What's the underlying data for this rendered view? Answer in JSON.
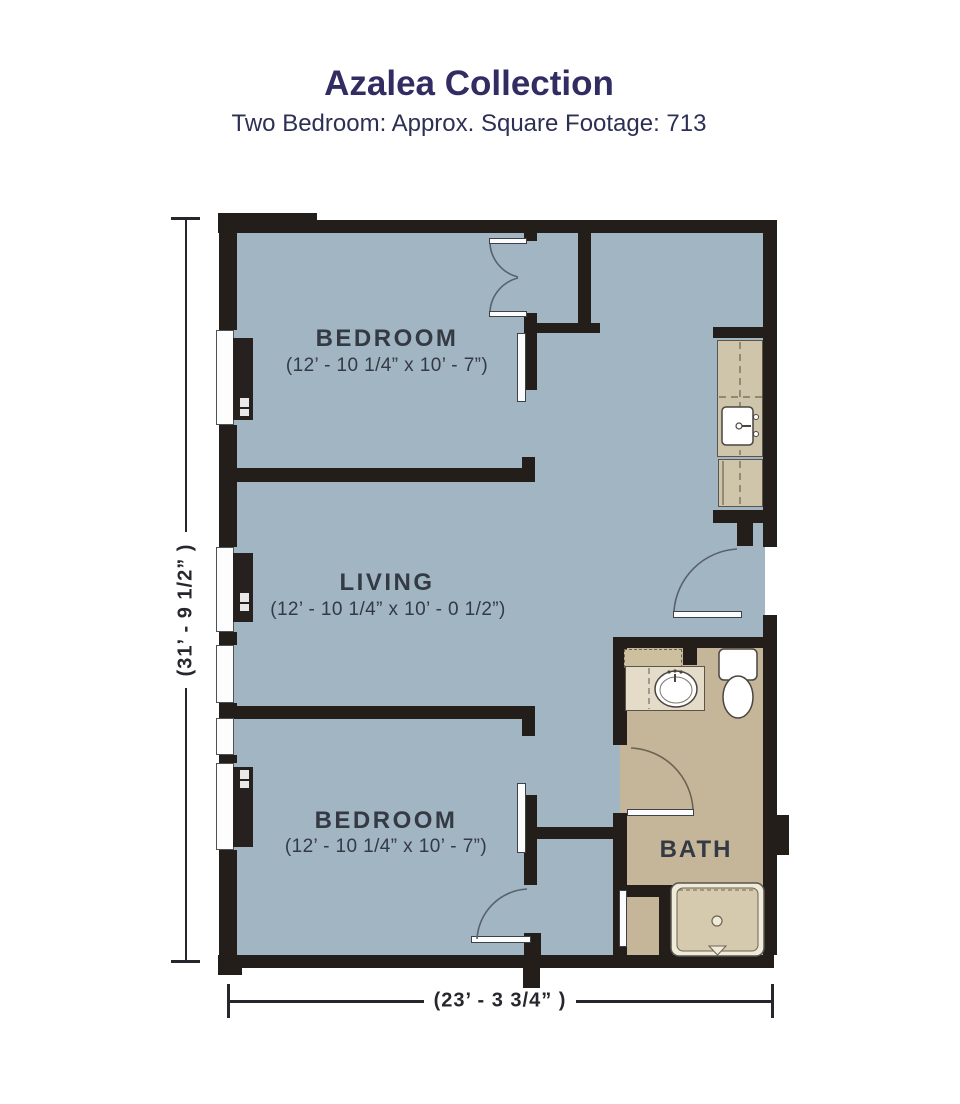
{
  "header": {
    "title": "Azalea Collection",
    "subtitle": "Two Bedroom: Approx. Square Footage: 713"
  },
  "rooms": {
    "bedroom_top": {
      "label": "BEDROOM",
      "dims": "(12’ - 10 1/4” x 10’ - 7”)"
    },
    "living": {
      "label": "LIVING",
      "dims": "(12’ - 10 1/4” x 10’ - 0 1/2”)"
    },
    "bedroom_bottom": {
      "label": "BEDROOM",
      "dims": "(12’ - 10 1/4” x 10’ - 7”)"
    },
    "bath": {
      "label": "BATH"
    }
  },
  "dimensions": {
    "height_label": "(31’ - 9 1/2” )",
    "width_label": "(23’ - 3 3/4” )"
  },
  "colors": {
    "floor": "#a2b5c2",
    "bath_floor": "#c5b69a",
    "wall": "#241e1b",
    "title_navy": "#312d63",
    "label_slate": "#333a44",
    "shower_inner": "#d5caae",
    "counter_tan": "#cfc5ab"
  }
}
